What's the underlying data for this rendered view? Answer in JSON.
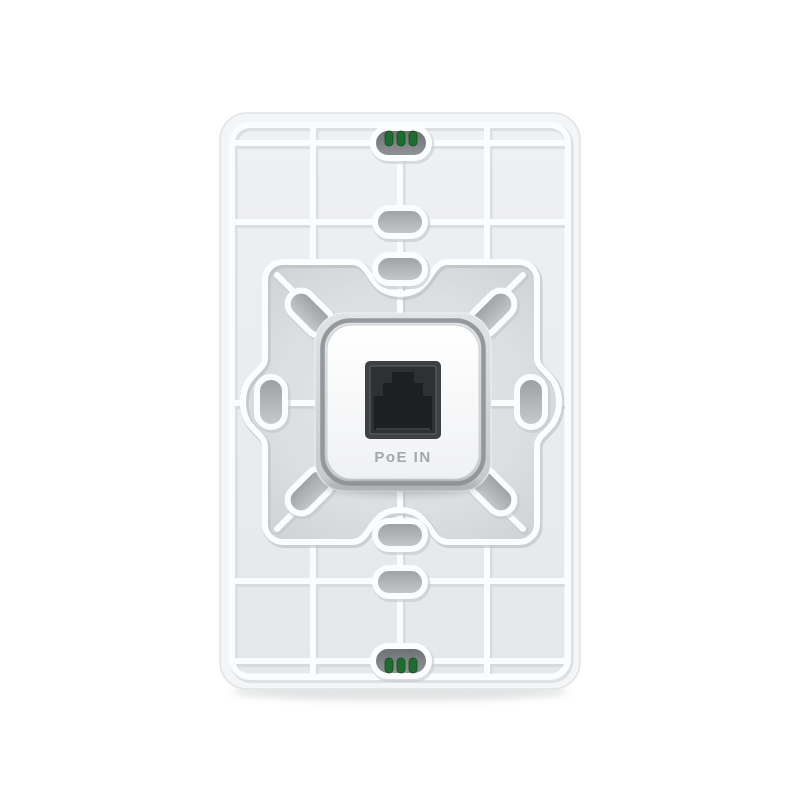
{
  "photo": {
    "kind": "product-photo",
    "subject": "Rear view of a white in-wall access point faceplate with ribbed back, recessed mounting area and PoE input port",
    "background_color": "#ffffff"
  },
  "device": {
    "body_color": "#eceef0",
    "rib_color": "#fbfcfe",
    "recess_color": "#d4d6d8",
    "plate_color": "#ffffff",
    "pin_color": "#1d6e2e",
    "pin_count_top": 3,
    "pin_count_bottom": 3,
    "oval_cutout_count": 10,
    "port": {
      "label": "PoE IN",
      "label_color": "#a4a7aa",
      "jack_color": "#1d1f21"
    }
  }
}
